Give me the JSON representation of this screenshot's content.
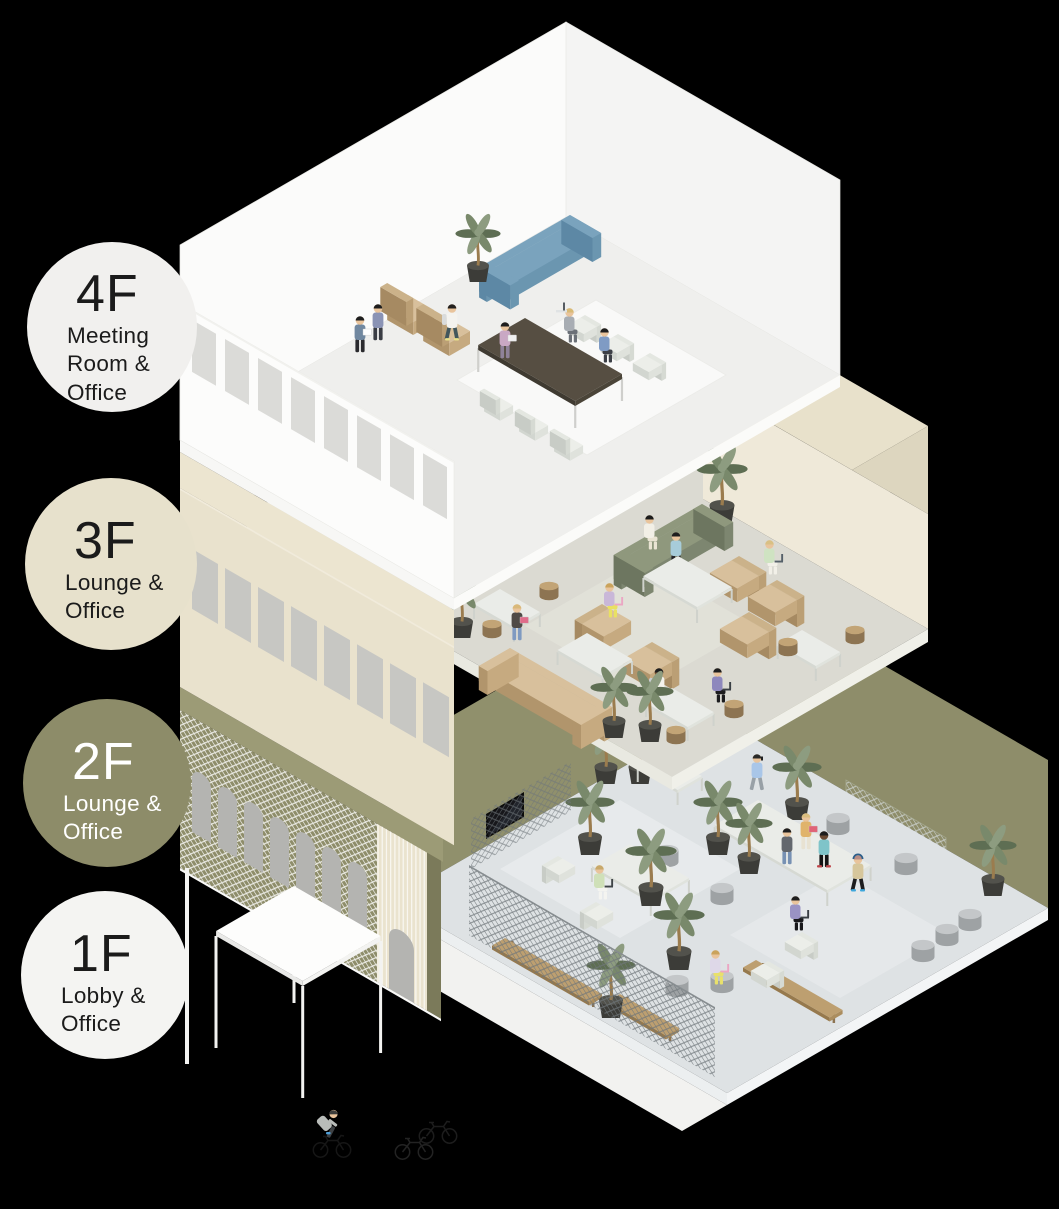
{
  "floors": [
    {
      "id": "4f",
      "label": "4F",
      "sublabel": [
        "Meeting",
        "Room &",
        "Office"
      ],
      "circle_color": "#f1f0ee",
      "text_color": "#1b1b1b",
      "use": "Meeting Room & Office"
    },
    {
      "id": "3f",
      "label": "3F",
      "sublabel": [
        "Lounge &",
        "Office"
      ],
      "circle_color": "#e7e1cc",
      "text_color": "#1b1b1b",
      "use": "Lounge & Office"
    },
    {
      "id": "2f",
      "label": "2F",
      "sublabel": [
        "Lounge &",
        "Office"
      ],
      "circle_color": "#8d8c69",
      "text_color": "#ffffff",
      "use": "Lounge & Office"
    },
    {
      "id": "1f",
      "label": "1F",
      "sublabel": [
        "Lobby &",
        "Office"
      ],
      "circle_color": "#f4f4f2",
      "text_color": "#1b1b1b",
      "use": "Lobby & Office"
    }
  ],
  "palette": {
    "background": "#000000",
    "olive_wall": "#8e8d6a",
    "olive_roof": "#9c9b76",
    "beige_wall": "#e9e2cd",
    "white_wall": "#fbfbfa",
    "lobby_floor": "#dee2e4",
    "lounge_floor": "#dbdad2",
    "plant_green": "#79896b",
    "plant_pot": "#3c3c38",
    "sofa_blue": "#6f9cb9",
    "sofa_green": "#8f987d",
    "sofa_tan": "#d8c09c",
    "wood": "#bd9f70",
    "window_gray": "#c7c7c3"
  }
}
